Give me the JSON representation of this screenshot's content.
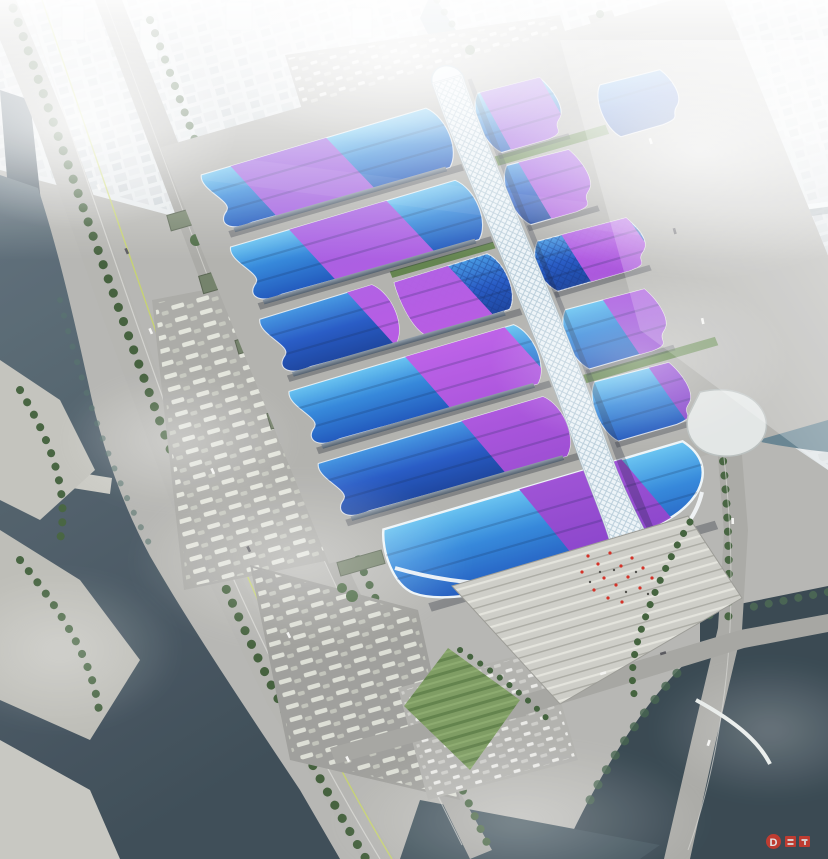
{
  "scene": {
    "description": "Aerial architectural rendering of a mega exhibition and convention center: paired wave-form blue exhibition hall roofs crossed by purple ribbon bands, a white quilted central concourse spine, a south entrance hall with stepped plaza, bounded by rivers, highways and a fog-shrouded city",
    "complex": {
      "west_hall_rows": 5,
      "east_hall_rows": 6,
      "central_spine": "white diamond-grid concourse canopy",
      "south_entrance": "wave-edged blue roof hall with white rim",
      "north_feature": "green roof gardens between halls",
      "plaza": "stepped light-stone plaza with red flags and palm trees"
    },
    "surroundings": [
      "west river with weir",
      "elevated expressway",
      "tree-lined boulevard",
      "bus and car parking lots",
      "warehouse sheds",
      "east winding river with skybridge",
      "hazy city skyline",
      "south ponds with arc footbridge",
      "sports field"
    ]
  },
  "watermark": {
    "label": "D",
    "color": "#d63a2c"
  },
  "palette": {
    "roof_cyan": "#66c4f2",
    "roof_blue": "#2f85da",
    "roof_deep": "#1a52ba",
    "roof_navy": "#153f9c",
    "ribbon_purple": "#c058e6",
    "ribbon_violet": "#8a3cc8",
    "spine_white": "#edf4f8",
    "spine_grid": "#b6cbd8",
    "pavement": "#b5b5b1",
    "plaza": "#cdcdc6",
    "road": "#a8a8a4",
    "tree_green": "#42603c",
    "lawn_green": "#6a8a55",
    "garden_green": "#5f8149",
    "water_west": "#4a5a66",
    "water_east": "#7c98a4",
    "pond": "#33434d",
    "city_haze": "#e8ecee",
    "fog": "#ffffff",
    "shed_roof": "#707e66"
  }
}
